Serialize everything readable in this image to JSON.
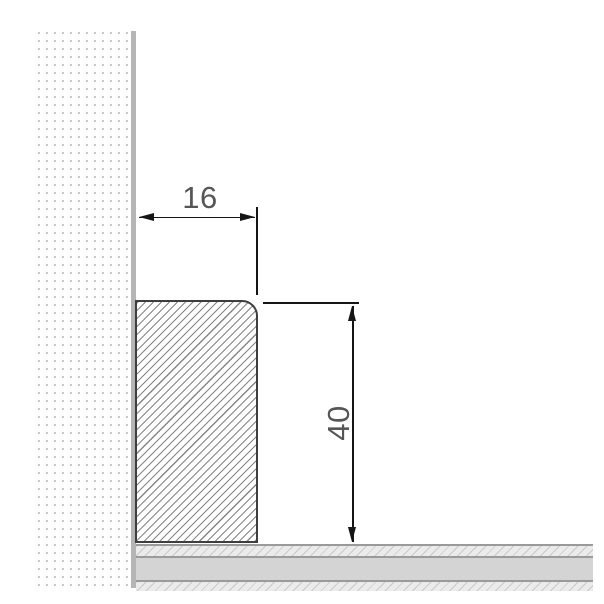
{
  "drawing": {
    "type": "skirting-board-cross-section",
    "dimensions": [
      {
        "name": "profile-width",
        "value": "16",
        "orientation": "horizontal",
        "unit": "mm"
      },
      {
        "name": "profile-height",
        "value": "40",
        "orientation": "vertical",
        "unit": "mm"
      }
    ],
    "parts": [
      {
        "name": "wall",
        "style": "stippled-dot-hatch"
      },
      {
        "name": "skirting-board",
        "style": "diagonal-hatch, rounded top-right corner"
      },
      {
        "name": "floor",
        "style": "three layers: hatch / solid / hatch"
      }
    ],
    "colors": {
      "background": "#ffffff",
      "dimension_line": "#151515",
      "dimension_text": "#565656",
      "board_outline": "#3e3e3e",
      "board_hatch": "#858585",
      "wall_dot": "#c7c7c7",
      "wall_edge": "#b5b5b5",
      "floor_core": "#d4d4d4",
      "floor_hatch_bg": "#ebebeb",
      "floor_hatch_line": "#c9c9c9",
      "floor_border": "#9a9a9a"
    }
  }
}
